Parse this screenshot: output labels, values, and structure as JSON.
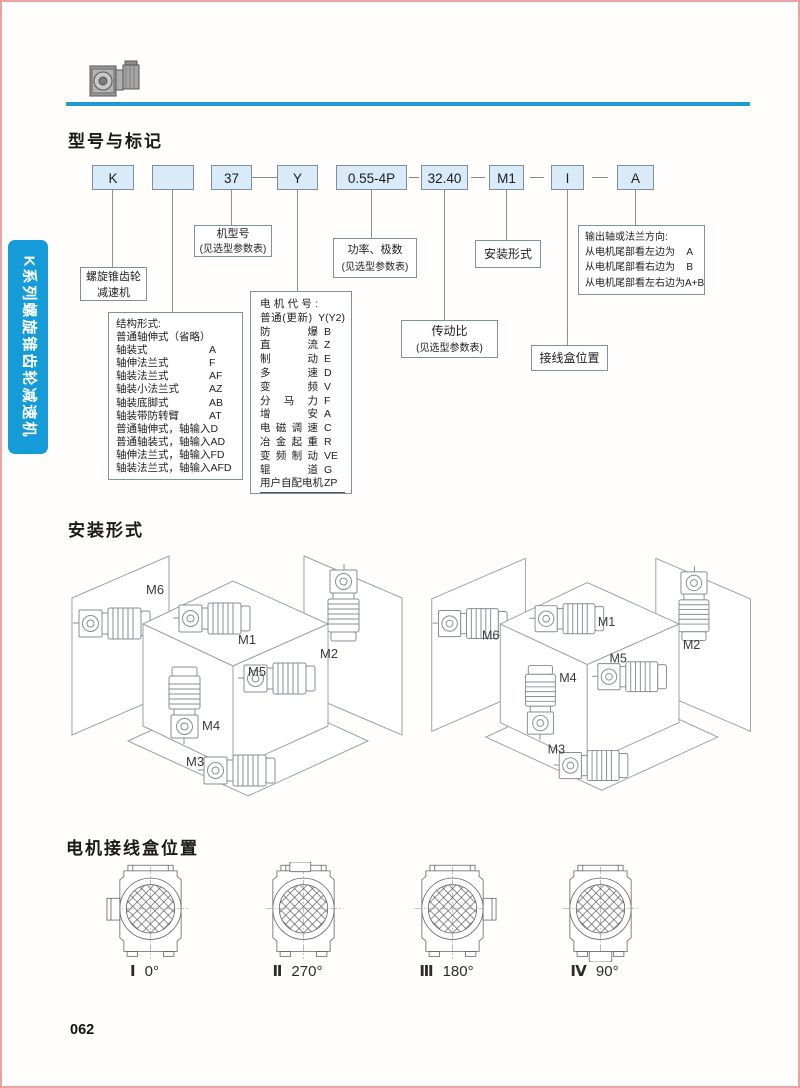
{
  "page": {
    "number": "062"
  },
  "sidebar": {
    "label": "K系列螺旋锥齿轮减速机"
  },
  "colors": {
    "accent_blue": "#1b9ad6",
    "sidebar_blue": "#149bd8",
    "code_box_fill": "#d9ebf9",
    "page_border_pink": "#e9a4a4"
  },
  "model_section": {
    "title": "型号与标记",
    "code_boxes": [
      "K",
      "",
      "37",
      "Y",
      "0.55-4P",
      "32.40",
      "M1",
      "I",
      "A"
    ],
    "annotations": {
      "reducer": {
        "line1": "螺旋锥齿轮",
        "line2": "减速机"
      },
      "frame": {
        "line1": "机型号",
        "line2": "(见选型参数表)"
      },
      "power": {
        "line1": "功率、极数",
        "line2": "(见选型参数表)"
      },
      "mounting": {
        "label": "安装形式"
      },
      "ratio": {
        "line1": "传动比",
        "line2": "(见选型参数表)"
      },
      "terminal": {
        "label": "接线盒位置"
      },
      "output": {
        "title": "输出轴或法兰方向:",
        "rows": [
          {
            "name": "从电机尾部看左边为",
            "code": "A"
          },
          {
            "name": "从电机尾部看右边为",
            "code": "B"
          },
          {
            "name": "从电机尾部看左右边为",
            "code": "A+B"
          }
        ]
      },
      "structure": {
        "title": "结构形式:",
        "subtitle": "普通轴伸式（省略）",
        "rows": [
          {
            "name": "轴装式",
            "code": "A"
          },
          {
            "name": "轴伸法兰式",
            "code": "F"
          },
          {
            "name": "轴装法兰式",
            "code": "AF"
          },
          {
            "name": "轴装小法兰式",
            "code": "AZ"
          },
          {
            "name": "轴装底脚式",
            "code": "AB"
          },
          {
            "name": "轴装带防转臂",
            "code": "AT"
          },
          {
            "name": "普通轴伸式，轴输入",
            "code": "D"
          },
          {
            "name": "普通轴装式，轴输入",
            "code": "AD"
          },
          {
            "name": "轴伸法兰式，轴输入",
            "code": "FD"
          },
          {
            "name": "轴装法兰式，轴输入",
            "code": "AFD"
          }
        ]
      },
      "motor": {
        "title": "电机代号:",
        "rows": [
          {
            "name": "普通(更新)",
            "code": "Y(Y2)"
          },
          {
            "name": "防爆",
            "code": "B"
          },
          {
            "name": "直流",
            "code": "Z"
          },
          {
            "name": "制动",
            "code": "E"
          },
          {
            "name": "多速",
            "code": "D"
          },
          {
            "name": "变频",
            "code": "V"
          },
          {
            "name": "分马力",
            "code": "F"
          },
          {
            "name": "增安",
            "code": "A"
          },
          {
            "name": "电磁调速",
            "code": "C"
          },
          {
            "name": "冶金起重",
            "code": "R"
          },
          {
            "name": "变频制动",
            "code": "VE"
          },
          {
            "name": "辊道",
            "code": "G"
          },
          {
            "name": "用户自配电机",
            "code": "ZP"
          }
        ]
      }
    }
  },
  "mounting_section": {
    "title": "安装形式",
    "labels": {
      "m1": "M1",
      "m2": "M2",
      "m3": "M3",
      "m4": "M4",
      "m5": "M5",
      "m6": "M6"
    }
  },
  "terminal_section": {
    "title": "电机接线盒位置",
    "positions": [
      {
        "numeral": "Ⅰ",
        "angle": "0°",
        "box_side": "left"
      },
      {
        "numeral": "Ⅱ",
        "angle": "270°",
        "box_side": "top"
      },
      {
        "numeral": "Ⅲ",
        "angle": "180°",
        "box_side": "right"
      },
      {
        "numeral": "Ⅳ",
        "angle": "90°",
        "box_side": "bottom"
      }
    ]
  }
}
